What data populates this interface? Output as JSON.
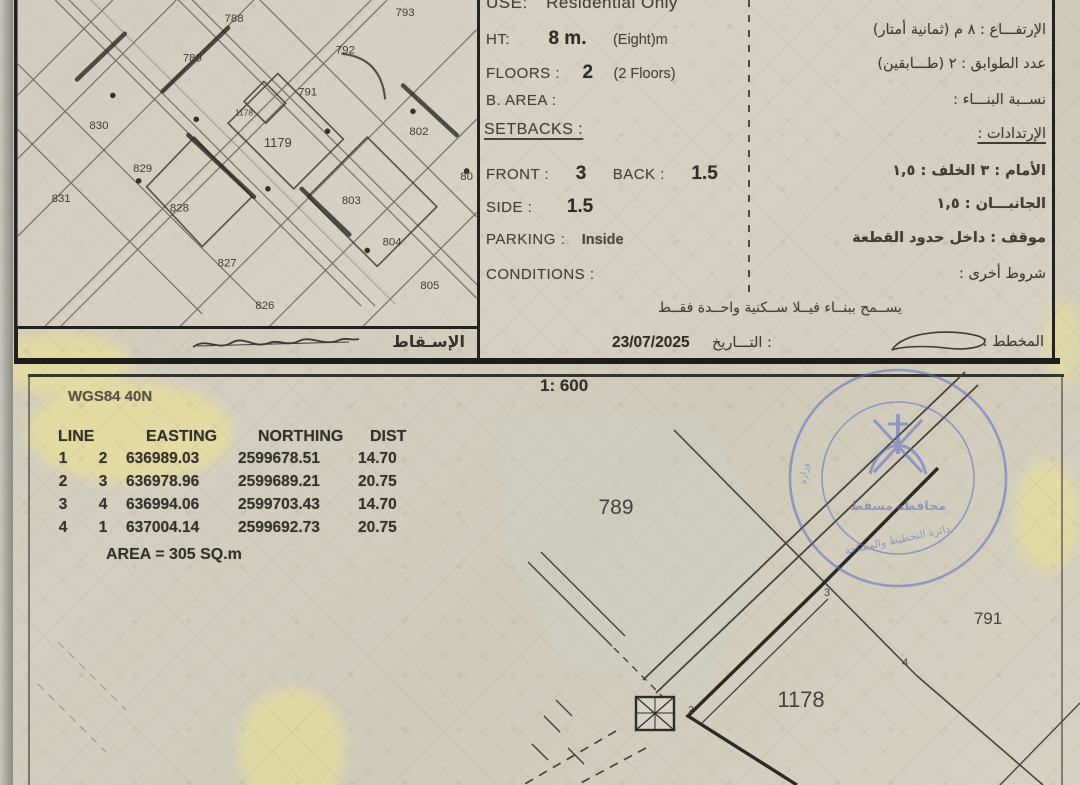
{
  "map": {
    "projection_label": "الإسـقاط",
    "plot_labels": [
      {
        "t": "788",
        "x": 218,
        "y": 22
      },
      {
        "t": "793",
        "x": 390,
        "y": 16
      },
      {
        "t": "789",
        "x": 176,
        "y": 62
      },
      {
        "t": "792",
        "x": 330,
        "y": 54
      },
      {
        "t": "791",
        "x": 292,
        "y": 96
      },
      {
        "t": "1178",
        "x": 228,
        "y": 116,
        "s": 8.5
      },
      {
        "t": "1179",
        "x": 262,
        "y": 148,
        "s": 13
      },
      {
        "t": "830",
        "x": 82,
        "y": 130
      },
      {
        "t": "829",
        "x": 126,
        "y": 173
      },
      {
        "t": "831",
        "x": 44,
        "y": 203
      },
      {
        "t": "828",
        "x": 163,
        "y": 213
      },
      {
        "t": "827",
        "x": 211,
        "y": 268
      },
      {
        "t": "826",
        "x": 249,
        "y": 311
      },
      {
        "t": "802",
        "x": 404,
        "y": 136
      },
      {
        "t": "80",
        "x": 452,
        "y": 181
      },
      {
        "t": "803",
        "x": 336,
        "y": 205
      },
      {
        "t": "804",
        "x": 377,
        "y": 247
      },
      {
        "t": "805",
        "x": 415,
        "y": 291
      }
    ]
  },
  "regulations": {
    "use_label": "USE:",
    "use_value": "Residential Only",
    "ht_label": "HT:",
    "ht_value": "8 m.",
    "ht_note": "(Eight)m",
    "floors_label": "FLOORS :",
    "floors_value": "2",
    "floors_note": "(2 Floors)",
    "barea_label": "B. AREA :",
    "setbacks_label": "SETBACKS :",
    "front_label": "FRONT :",
    "front_value": "3",
    "back_label": "BACK :",
    "back_value": "1.5",
    "side_label": "SIDE :",
    "side_value": "1.5",
    "parking_label": "PARKING :",
    "parking_value": "Inside",
    "conditions_label": "CONDITIONS :"
  },
  "regulations_ar": {
    "height_line": "الإرتفـــاع :  ٨   م   (ثمانية أمتار)",
    "floors_line": "عدد الطوابق :  ٢   (طـــابقين)",
    "ratio_line": "نســبة البنـــاء :",
    "setbacks_line": "الإرتدادات :",
    "front_back_line": "الأمام :  ٣    الخلف :  ١,٥",
    "sides_line": "الجانبـــان :   ١,٥",
    "parking_line": "موقف :   داخل حدود القطعة",
    "other_line": "شروط أخرى :"
  },
  "note_ar": "يســمح ببنــاء فيــلا ســكنية واحــدة فقــط",
  "footer": {
    "date_label_ar": "التـــاريخ :",
    "date_value": "23/07/2025",
    "planner_label_ar": "المخطط :"
  },
  "survey": {
    "datum": "WGS84 40N",
    "scale": "1: 600",
    "table_headers": [
      "LINE",
      "EASTING",
      "NORTHING",
      "DIST"
    ],
    "table_rows": [
      [
        "1",
        "2",
        "636989.03",
        "2599678.51",
        "14.70"
      ],
      [
        "2",
        "3",
        "636978.96",
        "2599689.21",
        "20.75"
      ],
      [
        "3",
        "4",
        "636994.06",
        "2599703.43",
        "14.70"
      ],
      [
        "4",
        "1",
        "637004.14",
        "2599692.73",
        "20.75"
      ]
    ],
    "area_text": "AREA = 305  SQ.m"
  },
  "plan": {
    "labels": [
      {
        "t": "789",
        "x": 616,
        "y": 514,
        "s": 21
      },
      {
        "t": "791",
        "x": 988,
        "y": 624,
        "s": 17
      },
      {
        "t": "1178",
        "x": 801,
        "y": 707,
        "s": 22
      },
      {
        "t": "3",
        "x": 827,
        "y": 596,
        "s": 11
      },
      {
        "t": "4",
        "x": 905,
        "y": 666,
        "s": 11
      },
      {
        "t": "2",
        "x": 691,
        "y": 713,
        "s": 10
      }
    ]
  },
  "stamp": {
    "arc_top": "وزارة الإسكان والتخطيط العمراني ـ سلطنة عمان",
    "center": "محافظة مسقط",
    "bottom": "دائرة التخطيط والمساحة"
  }
}
